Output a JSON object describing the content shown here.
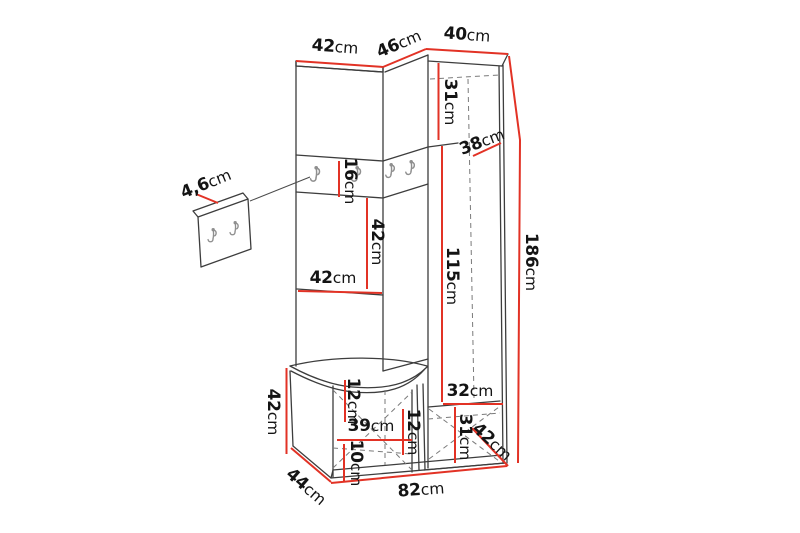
{
  "diagram": {
    "type": "furniture-dimension-drawing",
    "subject": "corner hallway wardrobe unit with hook strip, bench and separate wall hook panel",
    "colors": {
      "dimension_line": "#e23225",
      "outline": "#3d3d3d",
      "hidden_line": "#7a7a7a",
      "hook": "#8f8f8f",
      "label": "#141414",
      "background": "#ffffff"
    },
    "icons": {
      "hook": "wall-hook-icon"
    },
    "dimensions": {
      "top_left_width": {
        "value": "42",
        "unit": "cm"
      },
      "top_middle_width": {
        "value": "46",
        "unit": "cm"
      },
      "top_right_width": {
        "value": "40",
        "unit": "cm"
      },
      "total_height": {
        "value": "186",
        "unit": "cm"
      },
      "right_top_section_height": {
        "value": "31",
        "unit": "cm"
      },
      "right_top_depth": {
        "value": "38",
        "unit": "cm"
      },
      "right_middle_section_height": {
        "value": "115",
        "unit": "cm"
      },
      "hook_strip_height": {
        "value": "16",
        "unit": "cm"
      },
      "left_middle_section_height": {
        "value": "42",
        "unit": "cm"
      },
      "left_section_width": {
        "value": "42",
        "unit": "cm"
      },
      "wall_panel_thickness": {
        "value": "4,6",
        "unit": "cm"
      },
      "bench_height": {
        "value": "42",
        "unit": "cm"
      },
      "bench_top_section_height": {
        "value": "12",
        "unit": "cm"
      },
      "bench_opening_width": {
        "value": "39",
        "unit": "cm"
      },
      "bench_opening_height": {
        "value": "12",
        "unit": "cm"
      },
      "bench_bottom_section_height": {
        "value": "10",
        "unit": "cm"
      },
      "right_bottom_shelf_width": {
        "value": "32",
        "unit": "cm"
      },
      "right_bottom_section_height": {
        "value": "31",
        "unit": "cm"
      },
      "right_bottom_depth": {
        "value": "42",
        "unit": "cm"
      },
      "bench_depth": {
        "value": "44",
        "unit": "cm"
      },
      "total_width": {
        "value": "82",
        "unit": "cm"
      }
    }
  }
}
